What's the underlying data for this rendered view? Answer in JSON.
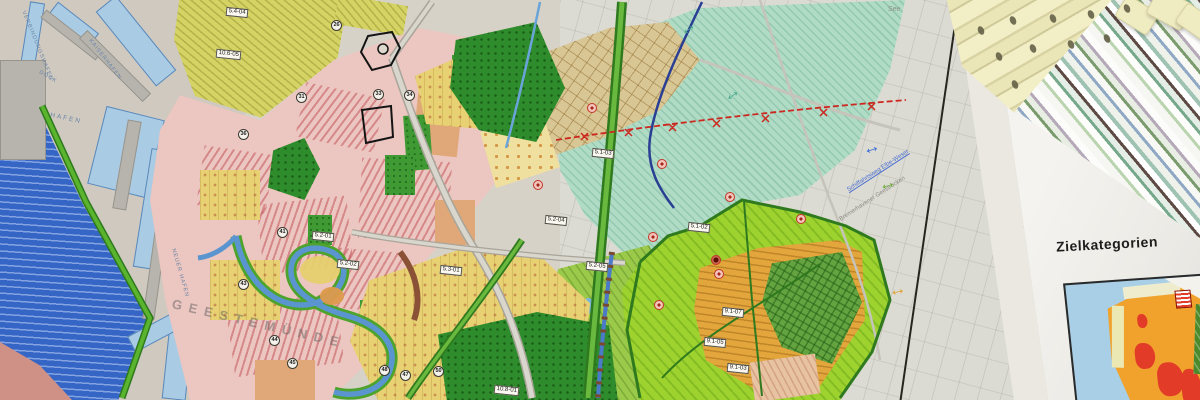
{
  "legend": {
    "title": "Zielkategorien",
    "partial_codes": [
      "7.1",
      "7.2",
      "7.3"
    ],
    "sections": [
      {
        "chip": "10.8",
        "heading": "Hohe Lie…",
        "rows": [
          {
            "code": "8.1",
            "label": "In den Pl…"
          },
          {
            "code": "8.2",
            "label": "Geestrand…"
          }
        ]
      },
      {
        "chip": "10.9",
        "heading": "Beverstedter …",
        "rows": [
          {
            "code": "9.1",
            "label": "Reinkenheide"
          },
          {
            "code": "9.2",
            "label": "Geestrandmoore"
          },
          {
            "code": "9.3",
            "label": "Surheide, Dülharm."
          }
        ]
      }
    ],
    "highlight_color": "#d9c83f",
    "swatch_colors": [
      "#dfa93b",
      "#dd9f35"
    ]
  },
  "map": {
    "harbor_labels": [
      {
        "text": "VERBINDUNGSHAFEN"
      },
      {
        "text": "DOCK"
      },
      {
        "text": "HAFEN"
      },
      {
        "text": "KAISERHAFEN"
      },
      {
        "text": "NEUER HAFEN"
      }
    ],
    "district_label": "GEESTEMÜNDE",
    "terrain_labels": [
      {
        "text": "See"
      },
      {
        "text": "Schiffahrtsweg Elbe-Weser"
      },
      {
        "text": "Bremerhavener Geestrücken"
      }
    ],
    "area_codes": [
      {
        "text": "5.4-04"
      },
      {
        "text": "10.6-05"
      },
      {
        "text": "5.2-04"
      },
      {
        "text": "5.2-05"
      },
      {
        "text": "5.3-01"
      },
      {
        "text": "5.2-01"
      },
      {
        "text": "5.2-02"
      },
      {
        "text": "5.1-03"
      },
      {
        "text": "5.1-02"
      },
      {
        "text": "9.1-07"
      },
      {
        "text": "9.1-05"
      },
      {
        "text": "9.1-03"
      },
      {
        "text": "10.8-01"
      }
    ],
    "route_markers": [
      {
        "text": "26"
      },
      {
        "text": "31"
      },
      {
        "text": "33"
      },
      {
        "text": "34"
      },
      {
        "text": "36"
      },
      {
        "text": "41"
      },
      {
        "text": "43"
      },
      {
        "text": "44"
      },
      {
        "text": "45"
      },
      {
        "text": "47"
      },
      {
        "text": "48"
      },
      {
        "text": "50"
      }
    ],
    "symbols": {
      "double_arrow": "↔"
    }
  },
  "colors": {
    "harbor_water": "#a9cbe4",
    "weser_blue": "#3565c5",
    "urban_pink": "#ecc6c0",
    "mint_green": "#b0dcc6",
    "lime_green": "#9ed32f",
    "field_orange": "#e2a63c",
    "forest_green": "#2f8c2c",
    "field_yellow": "#e8d172",
    "cadastral_gray": "#dcdbd3",
    "inset_water": "#a8cfe6",
    "inset_orange": "#f0a22c",
    "inset_red": "#e23c28"
  }
}
